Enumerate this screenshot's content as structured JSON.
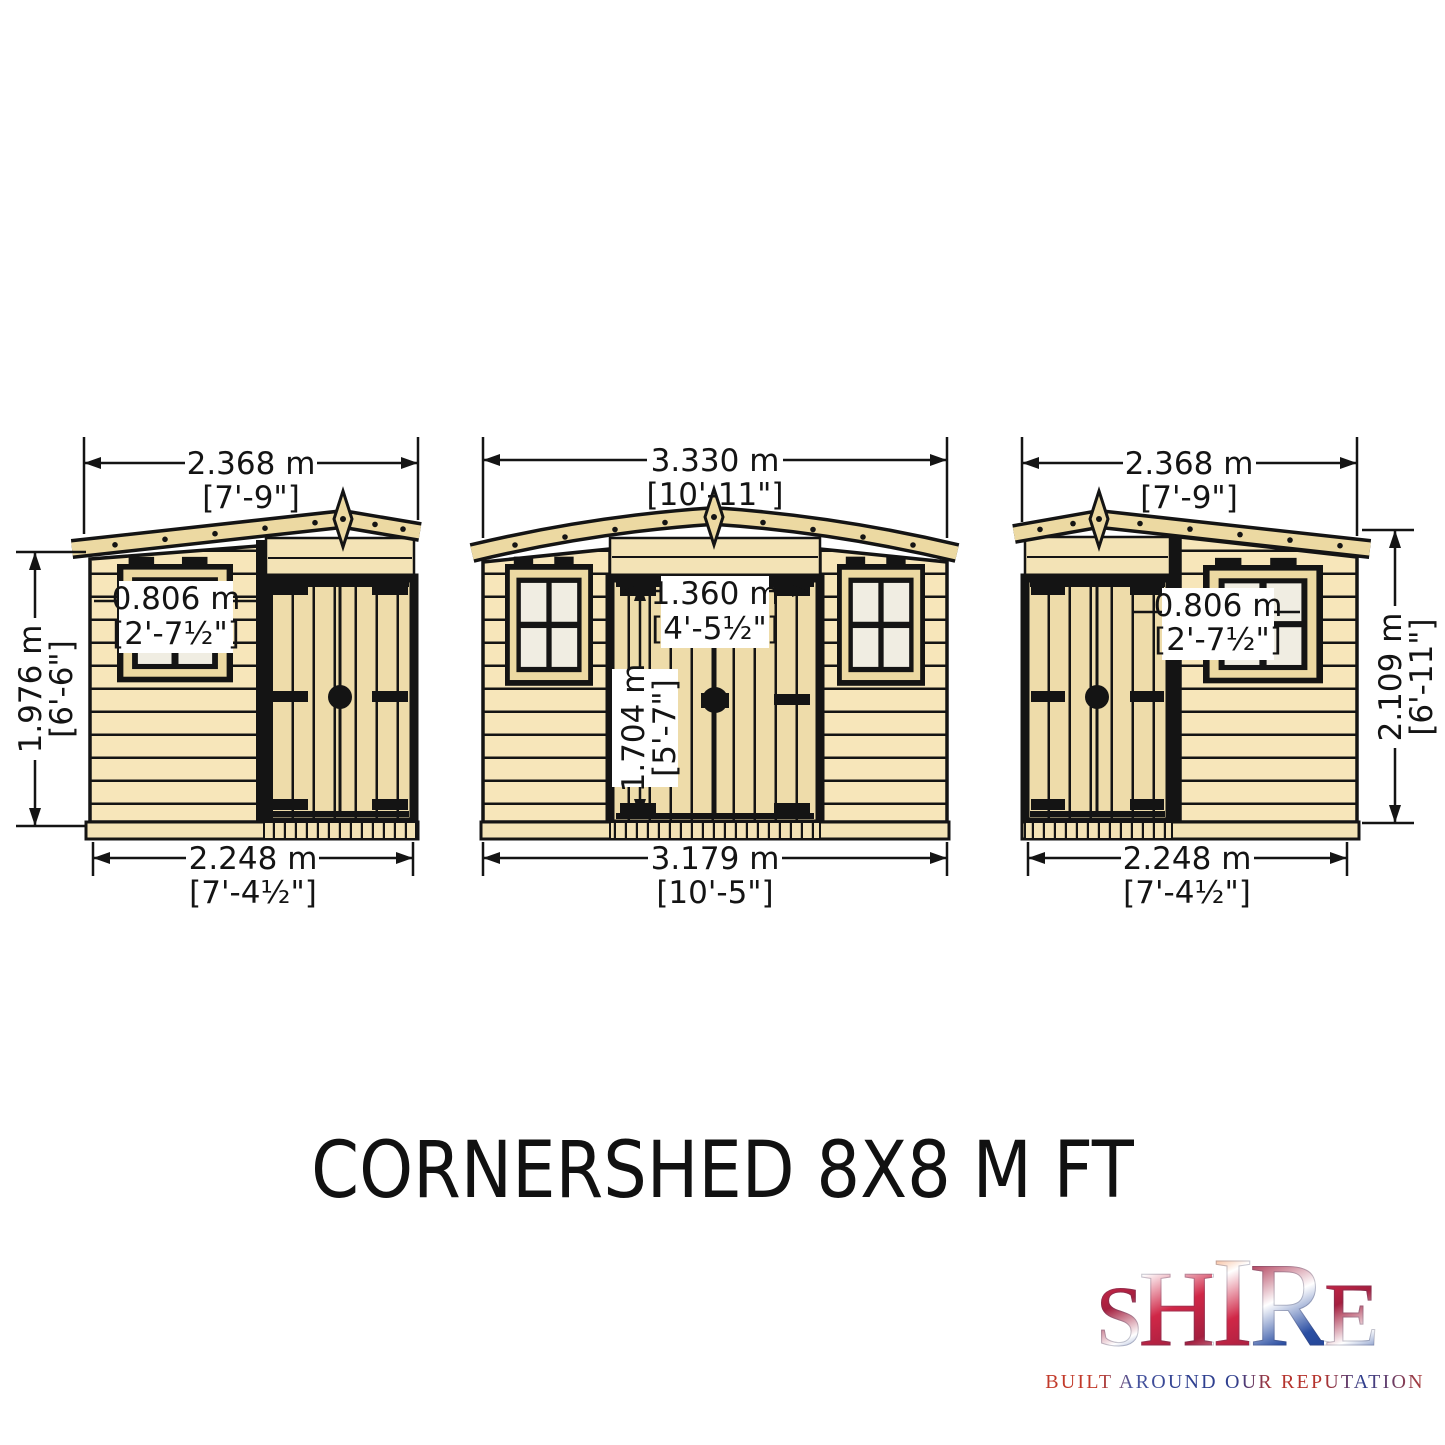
{
  "title": "CORNERSHED 8X8 M FT",
  "colors": {
    "clapboard": "#f7e6ba",
    "plank": "#eedcaa",
    "trim": "#ecd9a2",
    "lintel": "#f3e3b6",
    "pane": "#f0ede2",
    "ink": "#141414",
    "logo_red": "#c8352b",
    "logo_blue": "#24418f"
  },
  "views": {
    "left": {
      "dims": {
        "top": {
          "metric": "2.368 m",
          "imperial": "[7'-9\"]"
        },
        "height": {
          "metric": "1.976 m",
          "imperial": "[6'-6\"]"
        },
        "window": {
          "metric": "0.806 m",
          "imperial": "[2'-7½\"]"
        },
        "bottom": {
          "metric": "2.248 m",
          "imperial": "[7'-4½\"]"
        }
      }
    },
    "front": {
      "dims": {
        "top": {
          "metric": "3.330 m",
          "imperial": "[10'-11\"]"
        },
        "door_width": {
          "metric": "1.360 m",
          "imperial": "[4'-5½\"]"
        },
        "door_height": {
          "metric": "1.704 m",
          "imperial": "[5'-7\"]"
        },
        "bottom": {
          "metric": "3.179 m",
          "imperial": "[10'-5\"]"
        }
      }
    },
    "right": {
      "dims": {
        "top": {
          "metric": "2.368 m",
          "imperial": "[7'-9\"]"
        },
        "window": {
          "metric": "0.806 m",
          "imperial": "[2'-7½\"]"
        },
        "height": {
          "metric": "2.109 m",
          "imperial": "[6'-11\"]"
        },
        "bottom": {
          "metric": "2.248 m",
          "imperial": "[7'-4½\"]"
        }
      }
    }
  },
  "logo": {
    "letters": [
      {
        "ch": "S"
      },
      {
        "ch": "H"
      },
      {
        "ch": "I"
      },
      {
        "ch": "R"
      },
      {
        "ch": "E"
      }
    ],
    "tagline": "BUILT AROUND OUR REPUTATION"
  }
}
